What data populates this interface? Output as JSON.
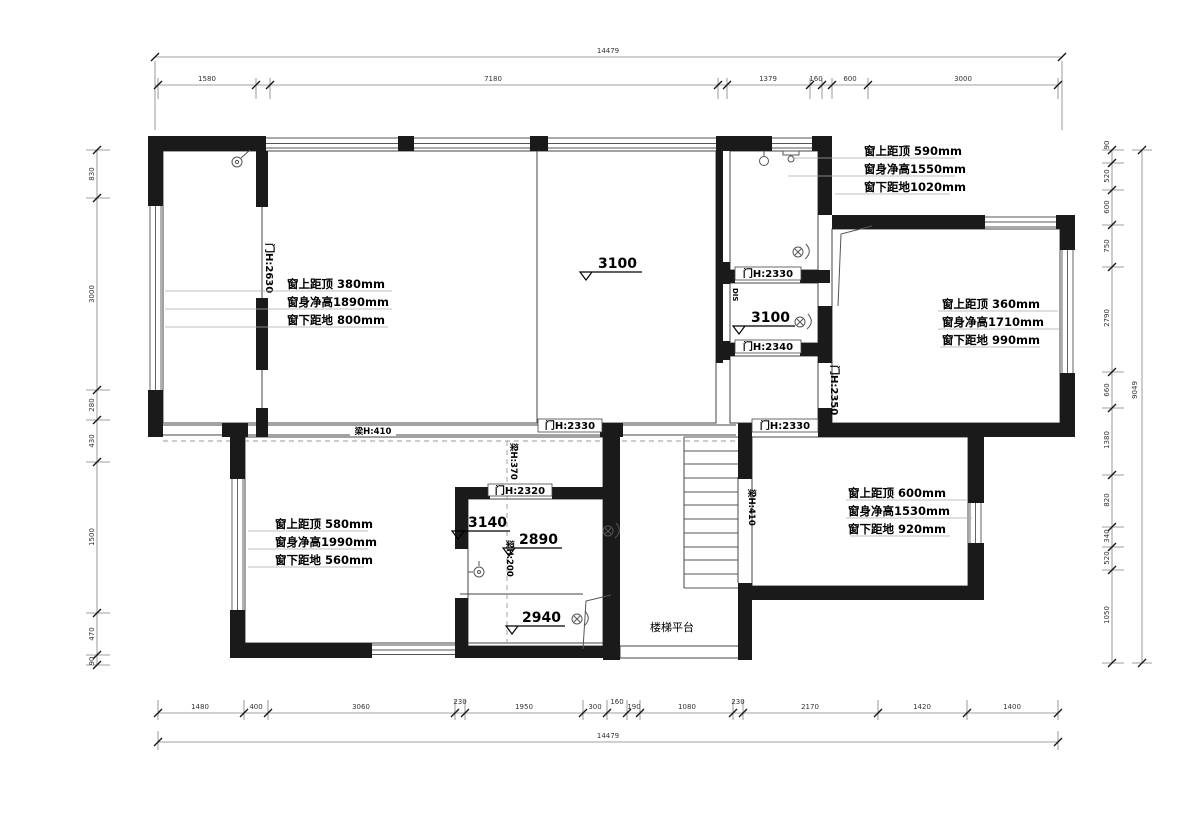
{
  "colors": {
    "wall": "#1a1a1a",
    "thin": "#444444",
    "dim": "#808080",
    "underline": "#aaaaaa"
  },
  "annotations": {
    "windows": [
      {
        "l1": "窗上距顶 590mm",
        "l2": "窗身净高1550mm",
        "l3": "窗下距地1020mm"
      },
      {
        "l1": "窗上距顶 380mm",
        "l2": "窗身净高1890mm",
        "l3": "窗下距地 800mm"
      },
      {
        "l1": "窗上距顶 360mm",
        "l2": "窗身净高1710mm",
        "l3": "窗下距地 990mm"
      },
      {
        "l1": "窗上距顶 580mm",
        "l2": "窗身净高1990mm",
        "l3": "窗下距地 560mm"
      },
      {
        "l1": "窗上距顶 600mm",
        "l2": "窗身净高1530mm",
        "l3": "窗下距地 920mm"
      }
    ]
  },
  "doors": {
    "d2630": "门H:2630",
    "d2330a": "门H:2330",
    "d2340": "门H:2340",
    "d2350": "门H:2350",
    "d2330b": "门H:2330",
    "d2330c": "门H:2330",
    "d2320": "门H:2320"
  },
  "beams": {
    "b410": "梁H:410",
    "b410b": "梁H:410",
    "b370": "梁H:370",
    "b200": "梁H:200"
  },
  "levels": [
    "3100",
    "3100",
    "3140",
    "2890",
    "2940"
  ],
  "labels": {
    "stair_platform": "楼梯平台",
    "dis": "DIS"
  },
  "dims": {
    "top_total": "14479",
    "top": [
      "1580",
      "7180",
      "1379",
      "160",
      "600",
      "3000"
    ],
    "bottom": [
      "1480",
      "400",
      "3060",
      "230",
      "1950",
      "300",
      "160",
      "190",
      "1080",
      "230",
      "2170",
      "1420",
      "1400"
    ],
    "bottom_total": "14479",
    "left": [
      "830",
      "3000",
      "280",
      "430",
      "1500",
      "470",
      "90"
    ],
    "right": [
      "90",
      "520",
      "600",
      "750",
      "2790",
      "660",
      "1380",
      "820",
      "340",
      "520",
      "1050"
    ],
    "right_total": "9049"
  }
}
